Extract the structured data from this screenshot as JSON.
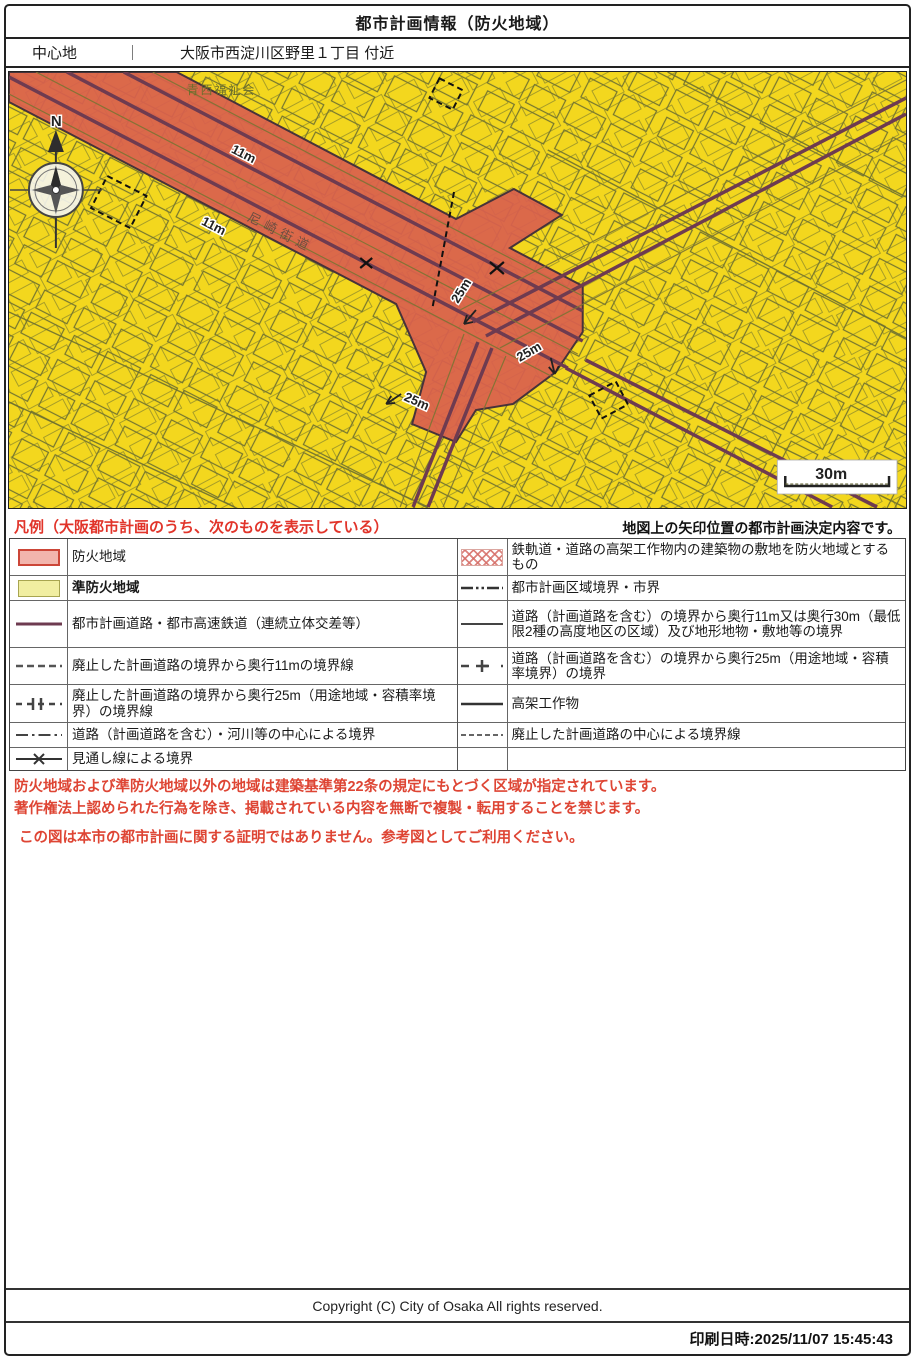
{
  "header": {
    "title": "都市計画情報（防火地域）"
  },
  "location_bar": {
    "label": "中心地",
    "separator": "｜",
    "value": "大阪市西淀川区野里１丁目 付近"
  },
  "map": {
    "compass_label": "N",
    "scale_label": "30m",
    "labels": {
      "facility": "青西福祉会",
      "road_name": "尼崎街道",
      "offsets_11m": [
        "11m",
        "11m"
      ],
      "offsets_25m": [
        "25m",
        "25m",
        "25m"
      ]
    },
    "colors": {
      "fire_district": "#d95f4e",
      "semi_fire_district": "#f3d71e",
      "planned_road_line": "#6e3b50",
      "parcel_line": "#6e7030"
    }
  },
  "legend": {
    "title_left": "凡例（大阪都市計画のうち、次のものを表示している）",
    "title_right": "地図上の矢印位置の都市計画決定内容です。",
    "left_rows": [
      {
        "label": "防火地域"
      },
      {
        "label": "準防火地域"
      },
      {
        "label": "都市計画道路・都市高速鉄道（連続立体交差等）"
      },
      {
        "label": "廃止した計画道路の境界から奥行11mの境界線"
      },
      {
        "label": "廃止した計画道路の境界から奥行25m（用途地域・容積率境界）の境界線"
      },
      {
        "label": "道路（計画道路を含む）・河川等の中心による境界"
      },
      {
        "label": "見通し線による境界"
      }
    ],
    "right_rows": [
      {
        "label": "鉄軌道・道路の高架工作物内の建築物の敷地を防火地域とするもの"
      },
      {
        "label": "都市計画区域境界・市界"
      },
      {
        "label": "道路（計画道路を含む）の境界から奥行11m又は奥行30m（最低限2種の高度地区の区域）及び地形地物・敷地等の境界"
      },
      {
        "label": "道路（計画道路を含む）の境界から奥行25m（用途地域・容積率境界）の境界"
      },
      {
        "label": "高架工作物"
      },
      {
        "label": "廃止した計画道路の中心による境界線"
      },
      {
        "label": ""
      }
    ]
  },
  "notes": [
    "防火地域および準防火地域以外の地域は建築基準第22条の規定にもとづく区域が指定されています。",
    "著作権法上認められた行為を除き、掲載されている内容を無断で複製・転用することを禁じます。",
    "この図は本市の都市計画に関する証明ではありません。参考図としてご利用ください。"
  ],
  "footer": {
    "copyright": "Copyright (C) City of Osaka All rights reserved.",
    "print_label": "印刷日時:2025/11/07 15:45:43"
  }
}
